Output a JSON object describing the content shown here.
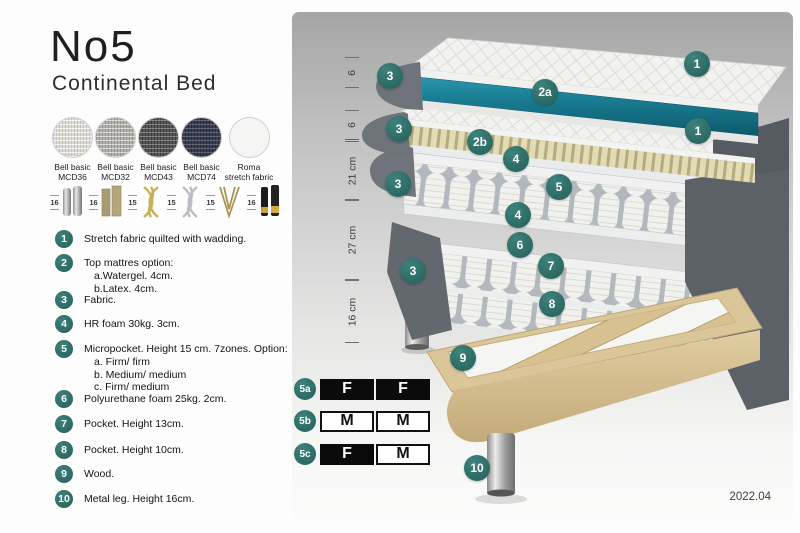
{
  "header": {
    "title": "No5",
    "subtitle": "Continental Bed"
  },
  "fabrics": [
    {
      "name": "Bell basic",
      "code": "MCD36"
    },
    {
      "name": "Bell basic",
      "code": "MCD32"
    },
    {
      "name": "Bell basic",
      "code": "MCD43"
    },
    {
      "name": "Bell basic",
      "code": "MCD74"
    },
    {
      "name": "Roma",
      "code": "stretch fabric"
    }
  ],
  "leg_options": [
    {
      "height": "16",
      "style": "cylinder-silver"
    },
    {
      "height": "16",
      "style": "block-brass"
    },
    {
      "height": "15",
      "style": "twisted-gold"
    },
    {
      "height": "15",
      "style": "twisted-silver"
    },
    {
      "height": "15",
      "style": "hairpin-gold"
    },
    {
      "height": "16",
      "style": "tapered-black-gold"
    }
  ],
  "features": [
    {
      "num": "1",
      "text": "Stretch fabric quilted with wadding."
    },
    {
      "num": "2",
      "text": "Top mattres option:",
      "sub": [
        "a.Watergel. 4cm.",
        "b.Latex. 4cm."
      ]
    },
    {
      "num": "3",
      "text": "Fabric."
    },
    {
      "num": "4",
      "text": "HR foam 30kg. 3cm."
    },
    {
      "num": "5",
      "text": "Micropocket. Height 15 cm. 7zones. Option:",
      "sub": [
        "a. Firm/ firm",
        "b. Medium/ medium",
        "c. Firm/ medium"
      ]
    },
    {
      "num": "6",
      "text": "Polyurethane foam 25kg. 2cm."
    },
    {
      "num": "7",
      "text": "Pocket. Height 13cm."
    },
    {
      "num": "8",
      "text": "Pocket. Height 10cm."
    },
    {
      "num": "9",
      "text": "Wood."
    },
    {
      "num": "10",
      "text": "Metal leg. Height 16cm."
    }
  ],
  "diagram": {
    "dims": [
      "6",
      "6",
      "21 cm",
      "27 cm",
      "16 cm"
    ],
    "labels": {
      "n1": "1",
      "n2a": "2a",
      "n2b": "2b",
      "n3": "3",
      "n4": "4",
      "n5": "5",
      "n6": "6",
      "n7": "7",
      "n8": "8",
      "n9": "9",
      "n10": "10"
    }
  },
  "firmness": {
    "rows": [
      {
        "label": "5a",
        "left": "F",
        "right": "F"
      },
      {
        "label": "5b",
        "left": "M",
        "right": "M"
      },
      {
        "label": "5c",
        "left": "F",
        "right": "M"
      }
    ]
  },
  "footer": {
    "version": "2022.04"
  },
  "colors": {
    "accent_teal": "#2e6f6a",
    "watergel_teal": "#1a7f95",
    "latex_yellow": "#ded8b0"
  }
}
